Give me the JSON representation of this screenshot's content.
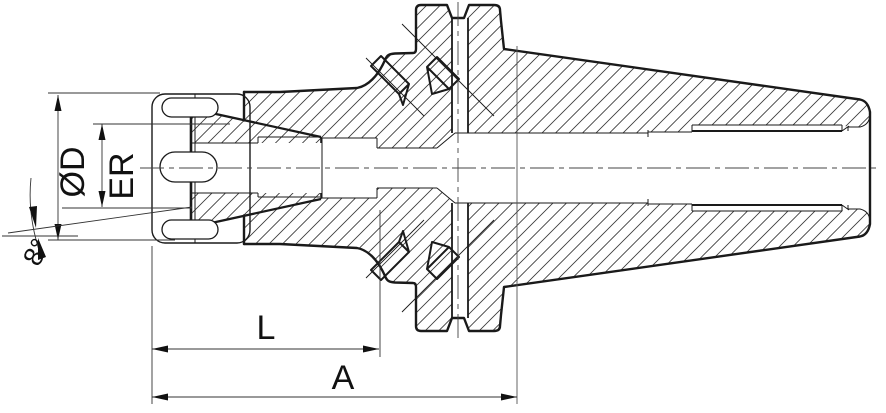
{
  "drawing": {
    "type": "technical-section-drawing",
    "subject": "ER collet chuck tool holder with taper shank, cross-section",
    "labels": {
      "diameter": "ØD",
      "collet": "ER",
      "angle": "8°",
      "gauge_length": "L",
      "overall_length": "A"
    },
    "colors": {
      "line": "#1a1a1a",
      "hatch": "#3a3a3a",
      "background": "#ffffff"
    }
  }
}
